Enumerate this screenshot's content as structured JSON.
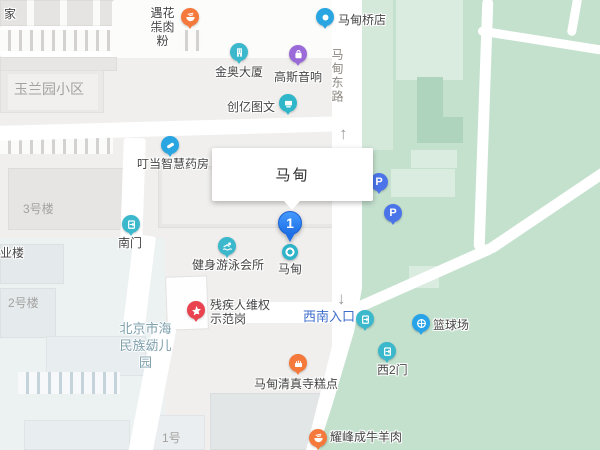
{
  "infobox": {
    "title": "马甸"
  },
  "marker": {
    "number": "1",
    "label": "马甸"
  },
  "road": {
    "name": "马甸东路"
  },
  "arrow_up": "↑",
  "arrow_down": "↓",
  "pois": {
    "beef_noodle": {
      "line1": "遇花溪苗家",
      "line2": "牛肉粉"
    },
    "madian_bridge_shop": {
      "label": "马甸桥店"
    },
    "jinao_tower": {
      "label": "金奥大厦"
    },
    "gauss_audio": {
      "label": "高斯音响"
    },
    "chuangyi_print": {
      "label": "创亿图文"
    },
    "dingdang_pharmacy": {
      "label": "叮当智慧药房"
    },
    "south_gate": {
      "label": "南门"
    },
    "fitness_swim_club": {
      "label": "健身游泳会所"
    },
    "rights_post": {
      "line1": "残疾人维权",
      "line2": "示范岗"
    },
    "southwest_entrance": {
      "label": "西南入口"
    },
    "basketball_court": {
      "label": "篮球场"
    },
    "west_gate_2": {
      "label": "西2门"
    },
    "mosque_bakery": {
      "label": "马甸清真寺糕点"
    },
    "yaofengcheng_meat": {
      "label": "耀峰成牛羊肉"
    },
    "parking": {
      "label": "P"
    }
  },
  "area_labels": {
    "top_left_partial": "家",
    "yulanyuan": "玉兰园小区",
    "building_3": "3号楼",
    "yelou_partial": "业楼",
    "building_2": "2号楼",
    "kindergarten_line1": "北京市海淀区",
    "kindergarten_line2": "民族幼儿园",
    "building_1": "1号"
  },
  "colors": {
    "park_green": "#c4e1ce",
    "pin_blue": "#2e7ff0",
    "teal_icon": "#3bb8cc",
    "blue_icon": "#29a6e1",
    "orange_icon": "#f5793b",
    "red_icon": "#e9434f",
    "purple_icon": "#9a6ad8",
    "parking_blue": "#4a74e8",
    "entrance_text_blue": "#3e6dcc"
  }
}
